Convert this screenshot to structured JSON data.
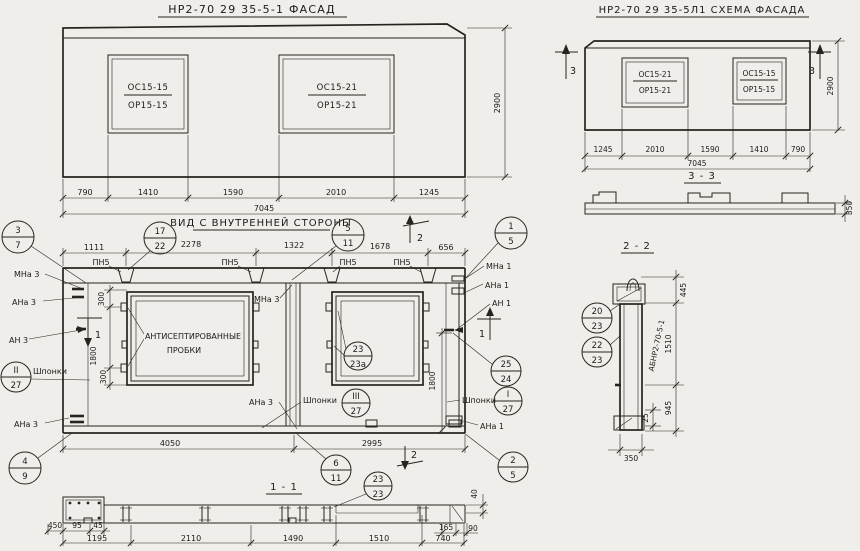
{
  "colors": {
    "paper": "#efeeea",
    "ink": "#26241f"
  },
  "facade": {
    "title": "НР2-70 29 35-5-1 ФАСАД",
    "win1_top": "ОС15-15",
    "win1_bot": "ОР15-15",
    "win2_top": "ОС15-21",
    "win2_bot": "ОР15-21",
    "dims": [
      "790",
      "1410",
      "1590",
      "2010",
      "1245"
    ],
    "total": "7045",
    "height": "2900"
  },
  "schema": {
    "title": "НР2-70 29 35-5Л1 СХЕМА ФАСАДА",
    "win1_top": "ОС15-21",
    "win1_bot": "ОР15-21",
    "win2_top": "ОС15-15",
    "win2_bot": "ОР15-15",
    "dims": [
      "1245",
      "2010",
      "1590",
      "1410",
      "790"
    ],
    "total": "7045",
    "height": "2900",
    "mark": "3"
  },
  "s33": {
    "title": "3 - 3",
    "thickness": "350"
  },
  "s22": {
    "title": "2 - 2",
    "part": "АБНР2-70-5-1",
    "c1_top": "20",
    "c1_bot": "23",
    "c2_top": "22",
    "c2_bot": "23",
    "d_top": "445",
    "d_mid": "1510",
    "d_bot": "945",
    "d_inset": "25",
    "d_w": "350"
  },
  "inner": {
    "title": "ВИД С ВНУТРЕННЕЙ СТОРОНЫ",
    "dims_top": [
      "1111",
      "2278",
      "1322",
      "1678",
      "656"
    ],
    "dim_4050": "4050",
    "dim_2995": "2995",
    "dim_300": "300",
    "dim_1800": "1800",
    "plugs1": "АНТИСЕПТИРОВАННЫЕ",
    "plugs2": "ПРОБКИ",
    "shponki": "Шпонки",
    "pn5": "ПН5",
    "mna3": "МНа 3",
    "ana3": "АНа 3",
    "an3": "АН 3",
    "mna1": "МНа 1",
    "ana1": "АНа 1",
    "an1": "АН 1",
    "mark1": "1",
    "mark2": "2",
    "c37t": "3",
    "c37b": "7",
    "c1722t": "17",
    "c1722b": "22",
    "c511t": "5",
    "c511b": "11",
    "c15t": "1",
    "c15b": "5",
    "cIIt": "II",
    "cIIb": "27",
    "cIIIt": "III",
    "cIIIb": "27",
    "cIt": "I",
    "cIb": "27",
    "c23t": "23",
    "c23b": "23а",
    "c2524t": "25",
    "c2524b": "24",
    "c49t": "4",
    "c49b": "9",
    "c611t": "6",
    "c611b": "11",
    "c25t": "2",
    "c25b": "5"
  },
  "s11": {
    "title": "1 - 1",
    "c_t": "23",
    "c_b": "23",
    "dims": [
      "1195",
      "2110",
      "1490",
      "1510",
      "740"
    ],
    "d450": "450",
    "d95": "95",
    "d45": "45",
    "d165": "165",
    "d90": "90",
    "d40": "40"
  }
}
